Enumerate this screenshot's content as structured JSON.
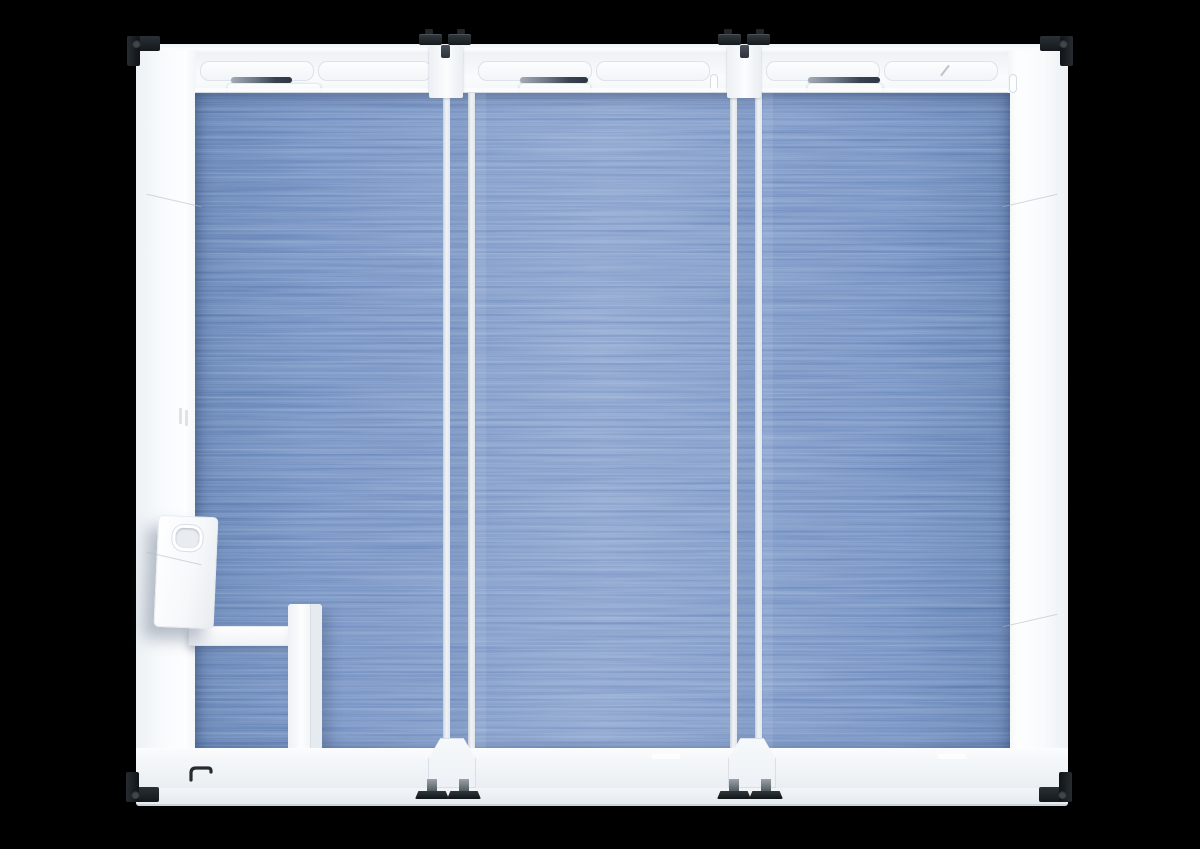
{
  "scene": {
    "view": "top-down 3d render",
    "subject": "three-bay modular glass pod with blue carpet floor",
    "bays": 3,
    "background": "#000000"
  },
  "colors": {
    "bg": "#000000",
    "wall": "#f3f6f8",
    "wall-bright": "#fbfdfe",
    "wall-shade": "#e9edf1",
    "wall-edge": "#d8dee4",
    "line": "#dde3e8",
    "carpet": "#6f8dc0",
    "carpet-light": "#87a0cc",
    "carpet-dark": "#5f7eb0",
    "hw": "#1d2226",
    "hw-mid": "#3f474e",
    "strip-dark": "#2c3743",
    "strip-light": "#a3acb6"
  },
  "parts": [
    "outer-frame",
    "top-wall-door-tracks",
    "sliding-door-leaf",
    "glass-top-edge-strip",
    "door-pull-pill",
    "glass-partition",
    "carpet-floor",
    "entry-vestibule-walls",
    "leaning-door-panel",
    "door-handle-icon",
    "corner-casting",
    "twist-lock-hardware",
    "partition-base",
    "leveling-feet"
  ]
}
